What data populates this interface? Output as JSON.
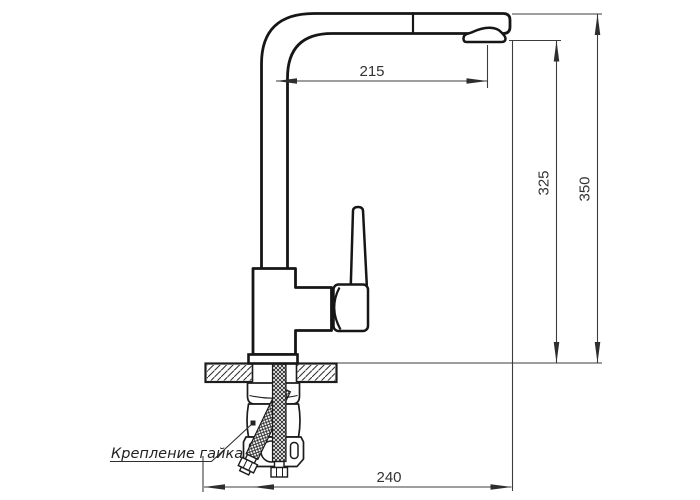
{
  "drawing": {
    "dimensions": {
      "spout_reach": "215",
      "height_to_spout_outlet": "325",
      "overall_height": "350",
      "base_depth": "240"
    },
    "labels": {
      "mounting_nut": "Крепление гайка"
    },
    "colors": {
      "background": "#ffffff",
      "outline": "#161616",
      "dimension_lines": "#3c3c3c",
      "dimension_text": "#333333"
    }
  }
}
